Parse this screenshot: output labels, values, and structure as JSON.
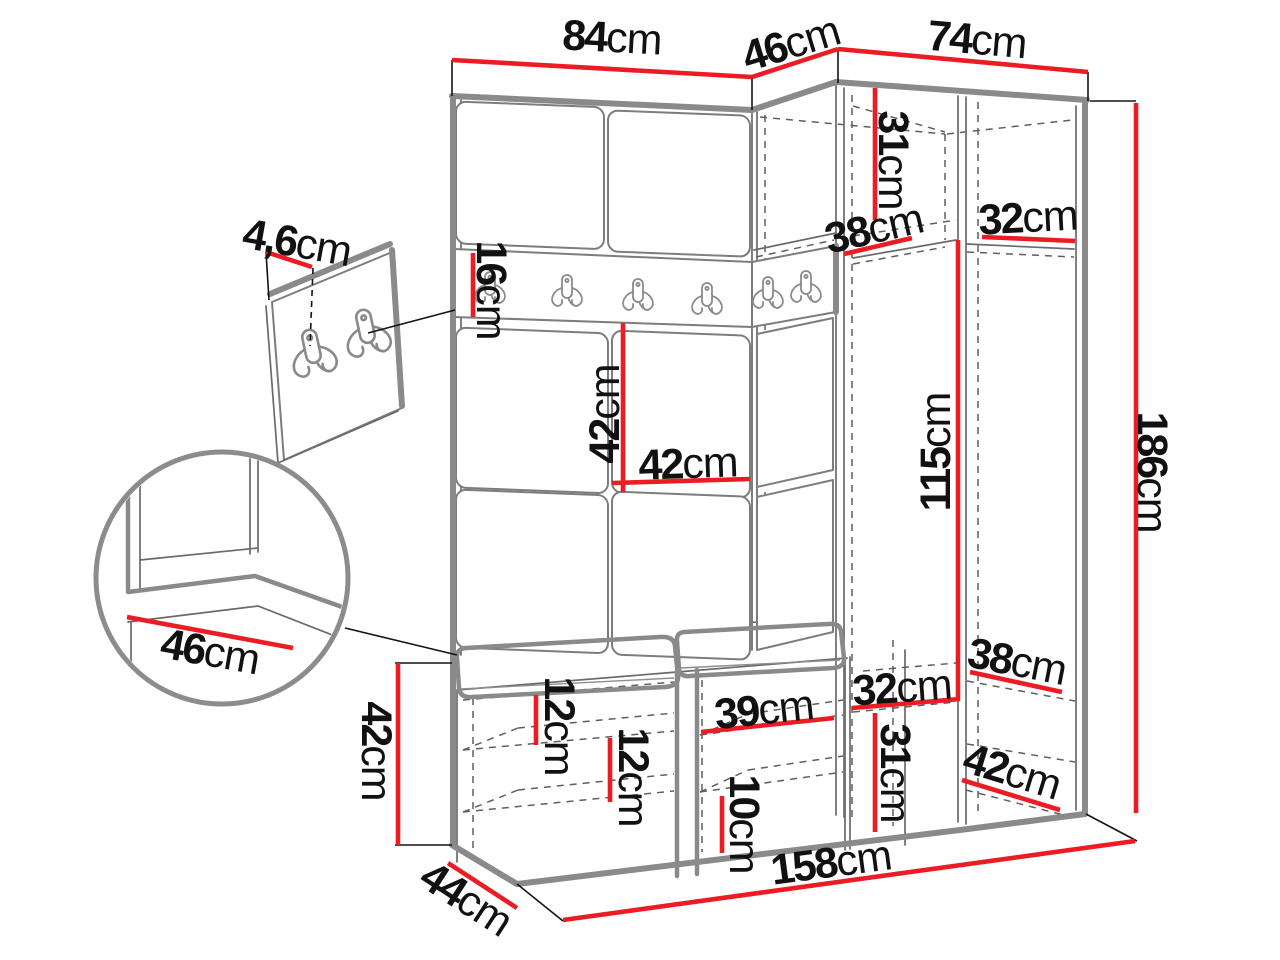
{
  "diagram": {
    "type": "furniture-dimension-diagram",
    "subject": "corner hallway wardrobe set with hook rail, bench and shoe storage",
    "unit_system": "cm",
    "colors": {
      "dimension_line": "#ec1c24",
      "structure": "#8a8a8a",
      "text": "#111111",
      "background": "#ffffff"
    },
    "icons": {
      "coat_hook": "double-prong coat hook"
    },
    "dimensions": [
      {
        "id": "width-left-section",
        "value": "84",
        "unit": "cm"
      },
      {
        "id": "width-corner-section",
        "value": "46",
        "unit": "cm"
      },
      {
        "id": "width-right-section",
        "value": "74",
        "unit": "cm"
      },
      {
        "id": "top-cabinet-height",
        "value": "31",
        "unit": "cm"
      },
      {
        "id": "top-shelf-depth-corner",
        "value": "38",
        "unit": "cm"
      },
      {
        "id": "top-shelf-width-right",
        "value": "32",
        "unit": "cm"
      },
      {
        "id": "hook-rail-height",
        "value": "16",
        "unit": "cm"
      },
      {
        "id": "wall-panel-height",
        "value": "42",
        "unit": "cm"
      },
      {
        "id": "wall-panel-width",
        "value": "42",
        "unit": "cm"
      },
      {
        "id": "open-section-height",
        "value": "115",
        "unit": "cm"
      },
      {
        "id": "total-height",
        "value": "186",
        "unit": "cm"
      },
      {
        "id": "hook-board-thickness",
        "value": "4,6",
        "unit": "cm"
      },
      {
        "id": "bench-seat-depth-detail",
        "value": "46",
        "unit": "cm"
      },
      {
        "id": "bench-height",
        "value": "42",
        "unit": "cm"
      },
      {
        "id": "bench-depth",
        "value": "44",
        "unit": "cm"
      },
      {
        "id": "bench-gap-upper",
        "value": "12",
        "unit": "cm"
      },
      {
        "id": "bench-gap-middle",
        "value": "12",
        "unit": "cm"
      },
      {
        "id": "bench-shelf-width",
        "value": "39",
        "unit": "cm"
      },
      {
        "id": "bench-gap-lower",
        "value": "10",
        "unit": "cm"
      },
      {
        "id": "bottom-corner-height",
        "value": "31",
        "unit": "cm"
      },
      {
        "id": "bottom-corner-width",
        "value": "32",
        "unit": "cm"
      },
      {
        "id": "bottom-shelf-depth",
        "value": "38",
        "unit": "cm"
      },
      {
        "id": "bottom-shelf-depth-right",
        "value": "42",
        "unit": "cm"
      },
      {
        "id": "total-width",
        "value": "158",
        "unit": "cm"
      }
    ]
  }
}
